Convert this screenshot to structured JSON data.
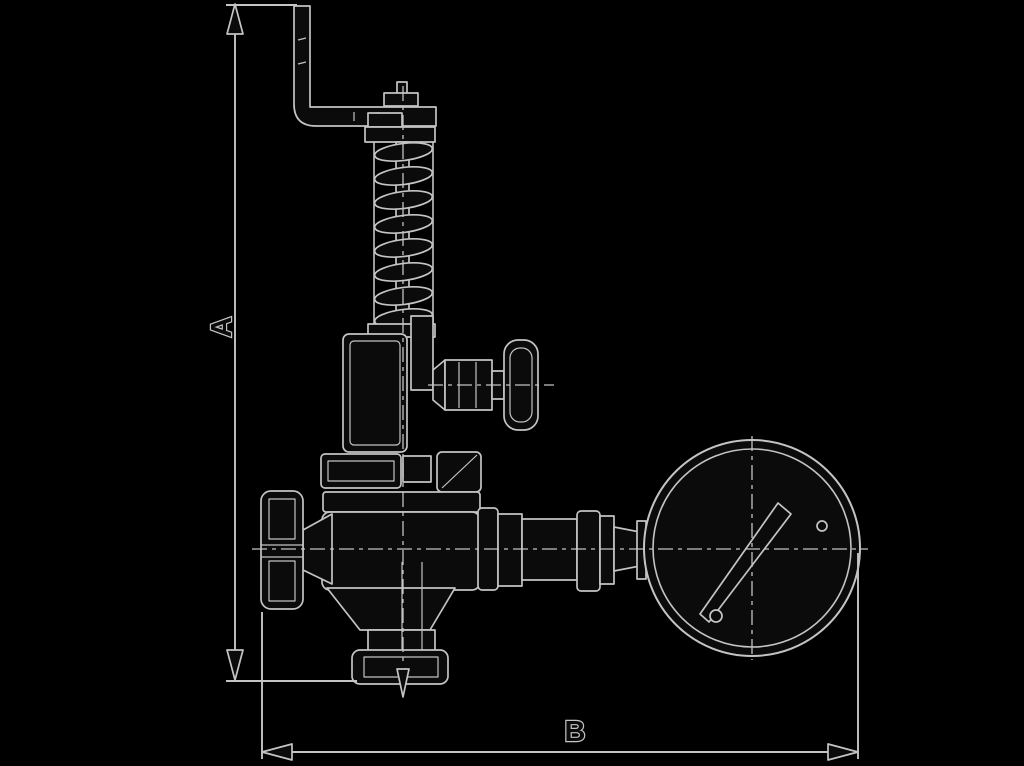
{
  "canvas": {
    "width": 1024,
    "height": 766,
    "background": "#000000"
  },
  "colors": {
    "bg": "#000000",
    "line": "#c4c4c4",
    "ink": "#0b0b0b"
  },
  "labels": {
    "dim_vertical": "A",
    "dim_horizontal": "B"
  },
  "diagram": {
    "type": "technical-line-drawing",
    "subject": "overflow / pressure relief valve with lifting lever, handwheel and pressure gauge, dimensioned A (height) and B (width)",
    "components": [
      "lifting-lever-arm",
      "adjusting-cap",
      "spring-column",
      "spring-bonnet",
      "test-cock-with-round-knob",
      "bonnet-flange",
      "valve-body",
      "handwheel",
      "bottom-outlet-flange",
      "flow-direction-arrow",
      "gauge-connection-piping",
      "pressure-gauge",
      "dimension-line-A",
      "dimension-line-B"
    ]
  }
}
